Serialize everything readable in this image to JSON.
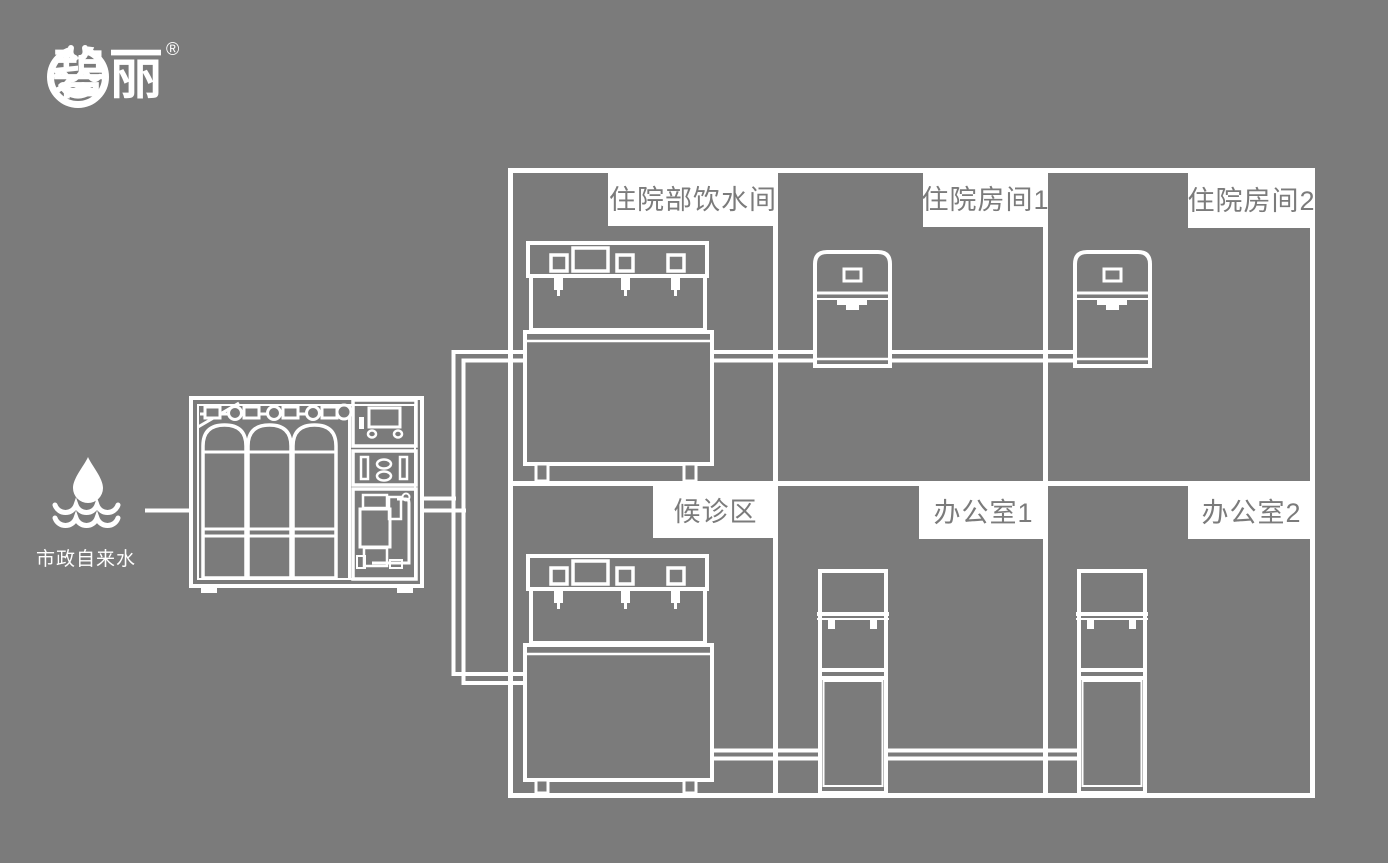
{
  "colors": {
    "background": "#7b7b7b",
    "line_art": "#ffffff",
    "label_background": "#ffffff",
    "label_text": "#7b7b7b"
  },
  "brand": {
    "name": "碧丽",
    "registered_mark": "®",
    "icon": "water-cup-icon"
  },
  "water_source": {
    "label": "市政自来水",
    "icon": "water-drop-over-waves-icon"
  },
  "machine": {
    "icon": "reverse-osmosis-water-treatment-machine"
  },
  "rooms": [
    {
      "label": "住院部饮水间",
      "equipment": "commercial-pipeline-drinking-machine"
    },
    {
      "label": "住院房间1",
      "equipment": "countertop-water-dispenser"
    },
    {
      "label": "住院房间2",
      "equipment": "countertop-water-dispenser"
    },
    {
      "label": "候诊区",
      "equipment": "commercial-pipeline-drinking-machine"
    },
    {
      "label": "办公室1",
      "equipment": "floor-standing-water-dispenser"
    },
    {
      "label": "办公室2",
      "equipment": "floor-standing-water-dispenser"
    }
  ]
}
